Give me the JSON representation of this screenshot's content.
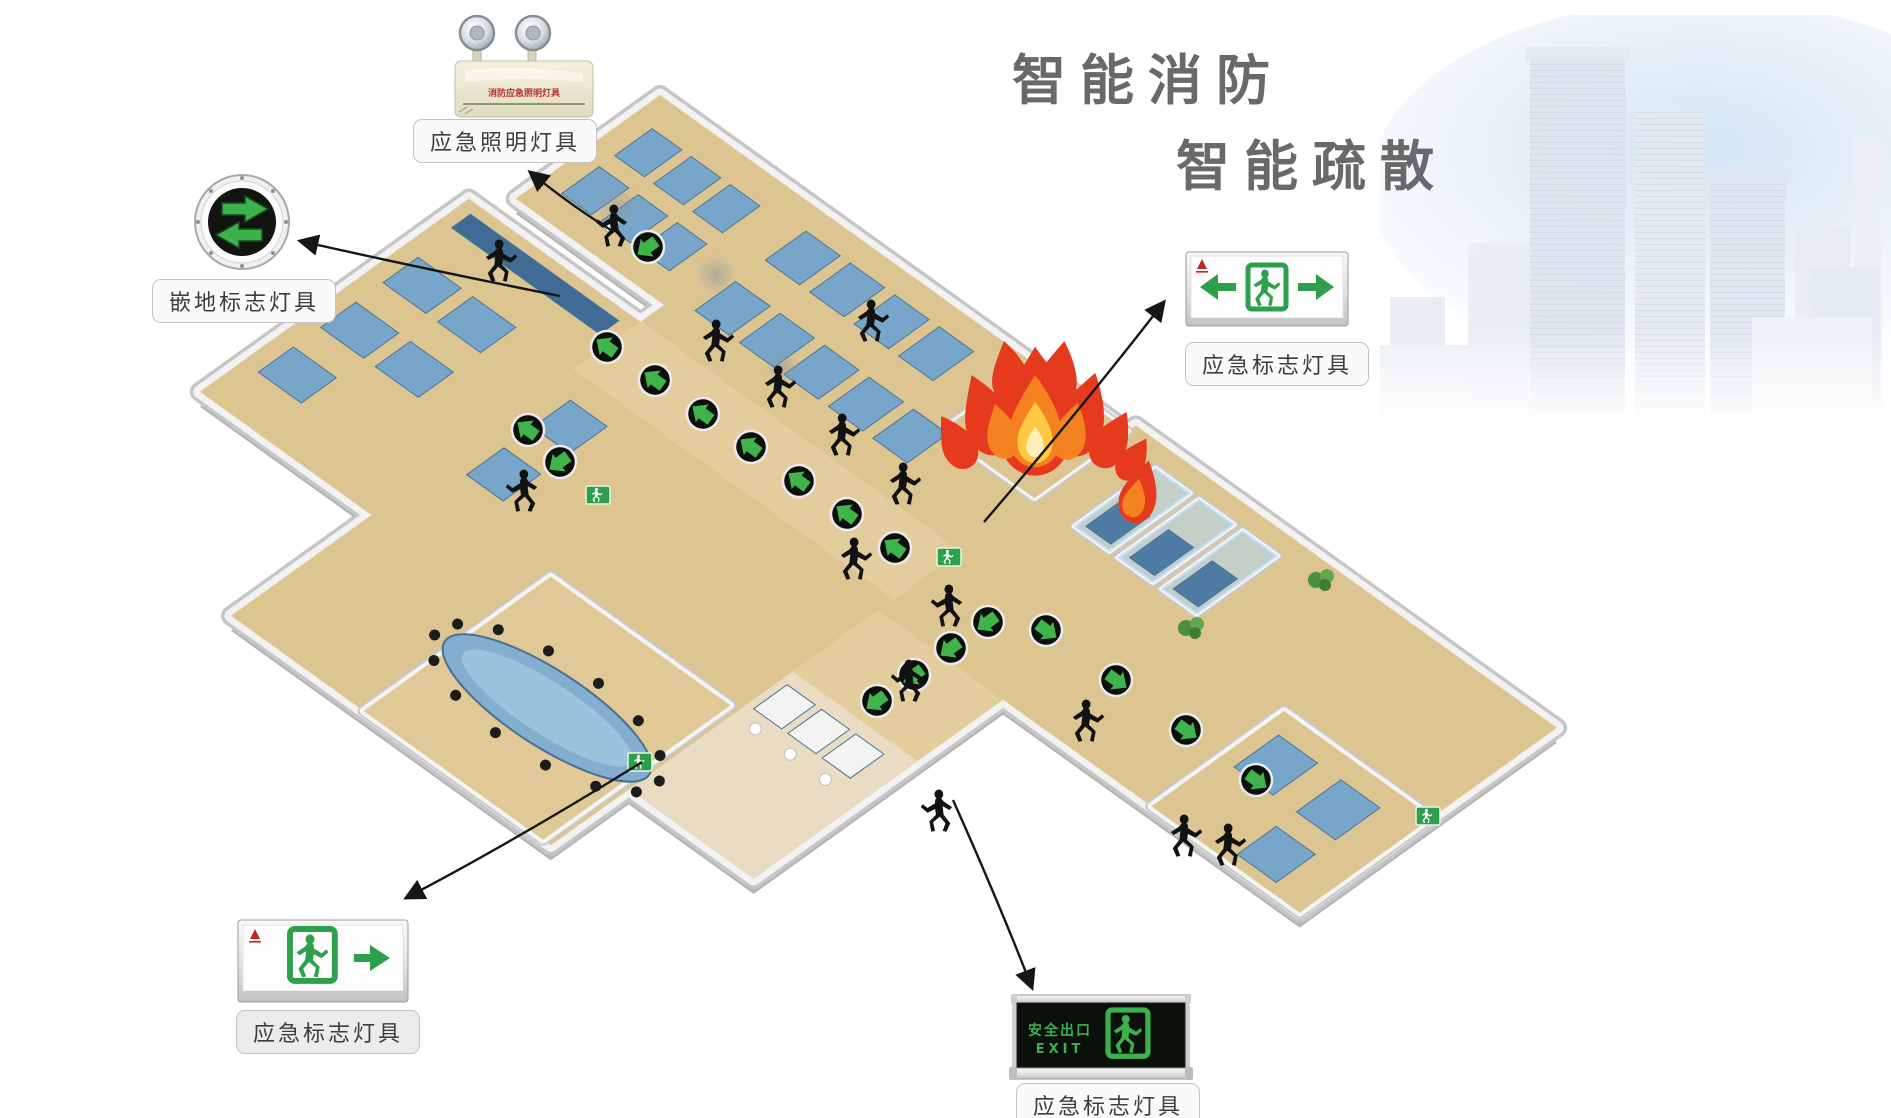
{
  "title": {
    "line1": "智能消防",
    "line2": "智能疏散"
  },
  "callouts": {
    "emergency_lighting": {
      "label": "应急照明灯具"
    },
    "ground_sign": {
      "label": "嵌地标志灯具"
    },
    "exit_sign_right": {
      "label": "应急标志灯具"
    },
    "exit_sign_left": {
      "label": "应急标志灯具"
    },
    "exit_sign_bottom": {
      "label": "应急标志灯具"
    }
  },
  "products": {
    "emergency_light_text": "消防应急照明灯具",
    "safety_exit_cn": "安全出口",
    "safety_exit_en": "EXIT"
  },
  "colors": {
    "title_gray": "#696969",
    "sign_green": "#2da04b",
    "indicator_green": "#3eb44a",
    "floor_tan": "#dcc591",
    "corridor_tan": "#e3cd9d",
    "wall_light": "#f2f2f2",
    "wall_shade": "#c6c6c6",
    "fire_red": "#e53a1e",
    "fire_orange": "#f58220",
    "fire_yellow": "#ffc840",
    "furniture_blue": "#78a6ca",
    "silhouette_black": "#121212"
  },
  "floorplan": {
    "indicators": [
      [
        607,
        347,
        -144
      ],
      [
        655,
        380,
        -144
      ],
      [
        703,
        414,
        -144
      ],
      [
        751,
        447,
        -144
      ],
      [
        799,
        481,
        -144
      ],
      [
        847,
        514,
        -144
      ],
      [
        895,
        548,
        -144
      ],
      [
        988,
        622,
        144
      ],
      [
        951,
        648,
        144
      ],
      [
        914,
        675,
        144
      ],
      [
        877,
        701,
        144
      ],
      [
        1046,
        630,
        36
      ],
      [
        1116,
        680,
        36
      ],
      [
        1186,
        730,
        36
      ],
      [
        1256,
        780,
        36
      ],
      [
        648,
        247,
        144
      ],
      [
        528,
        430,
        -144
      ],
      [
        560,
        462,
        144
      ]
    ],
    "people": [
      [
        483,
        240,
        1
      ],
      [
        630,
        205,
        -1
      ],
      [
        700,
        320,
        1
      ],
      [
        762,
        366,
        1
      ],
      [
        826,
        414,
        1
      ],
      [
        887,
        463,
        1
      ],
      [
        838,
        538,
        1
      ],
      [
        965,
        585,
        -1
      ],
      [
        925,
        660,
        -1
      ],
      [
        955,
        790,
        -1
      ],
      [
        1168,
        815,
        1
      ],
      [
        1212,
        824,
        1
      ],
      [
        1070,
        700,
        1
      ],
      [
        540,
        470,
        -1
      ],
      [
        855,
        300,
        1
      ]
    ],
    "wall_signs": [
      [
        598,
        495
      ],
      [
        640,
        762
      ],
      [
        949,
        557
      ],
      [
        1428,
        816
      ]
    ],
    "plants": [
      [
        1192,
        628
      ],
      [
        1322,
        580
      ]
    ],
    "glows": [
      [
        618,
        208,
        24
      ],
      [
        716,
        275,
        20
      ],
      [
        783,
        367,
        18
      ]
    ]
  }
}
